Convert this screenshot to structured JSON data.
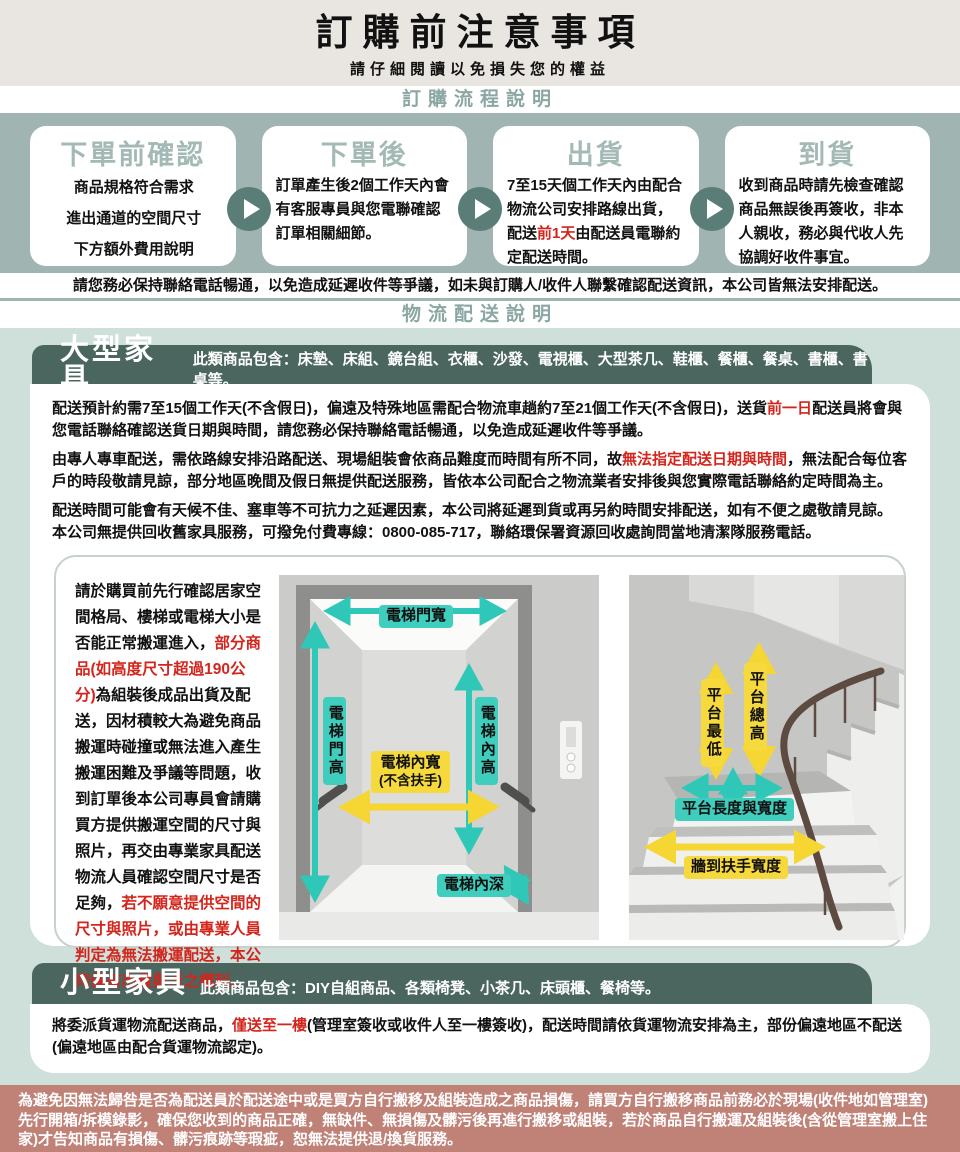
{
  "colors": {
    "band_teal": "#a0b5b1",
    "light_teal_bg": "#cfe0da",
    "dark_teal_header": "#4a665f",
    "heading_teal_text": "#8ba7a3",
    "step_title_teal": "#a3b9b5",
    "arrow_circle": "#5a7d77",
    "accent_red": "#d3251c",
    "diagram_teal": "#2fc8b8",
    "diagram_yellow": "#f5d632",
    "footer_brick": "#c08177"
  },
  "header": {
    "title": "訂購前注意事項",
    "subtitle": "請仔細閱讀以免損失您的權益"
  },
  "process": {
    "heading": "訂購流程說明",
    "steps": [
      {
        "title": "下單前確認",
        "body": [
          {
            "t": "商品規格符合需求"
          },
          {
            "br": true
          },
          {
            "t": "進出通道的空間尺寸"
          },
          {
            "br": true
          },
          {
            "t": "下方額外費用說明"
          }
        ]
      },
      {
        "title": "下單後",
        "body": [
          {
            "t": "訂單產生後2個工作天內會有客服專員與您電聯確認訂單相關細節。"
          }
        ]
      },
      {
        "title": "出貨",
        "body": [
          {
            "t": "7至15天個工作天內由配合物流公司安排路線出貨，配送"
          },
          {
            "t": "前1天",
            "red": true
          },
          {
            "t": "由配送員電聯約定配送時間。"
          }
        ]
      },
      {
        "title": "到貨",
        "body": [
          {
            "t": "收到商品時請先檢查確認商品無誤後再簽收，非本人親收，務必與代收人先協調好收件事宜。"
          }
        ]
      }
    ],
    "notice": "請您務必保持聯絡電話暢通，以免造成延遲收件等爭議，如未與訂購人/收件人聯繫確認配送資訊，本公司皆無法安排配送。"
  },
  "logistics": {
    "heading": "物流配送說明",
    "large": {
      "title": "大型家具",
      "includes": "此類商品包含：床墊、床組、鏡台組、衣櫃、沙發、電視櫃、大型茶几、鞋櫃、餐櫃、餐桌、書櫃、書桌等。",
      "p1": [
        {
          "t": "配送預計約需7至15個工作天(不含假日)，偏遠及特殊地區需配合物流車趟約7至21個工作天(不含假日)，送貨"
        },
        {
          "t": "前一日",
          "red": true
        },
        {
          "t": "配送員將會與您電話聯絡確認送貨日期與時間，請您務必保持聯絡電話暢通，以免造成延遲收件等爭議。"
        }
      ],
      "p2": [
        {
          "t": "由專人專車配送，需依路線安排沿路配送、現場組裝會依商品難度而時間有所不同，故"
        },
        {
          "t": "無法指定配送日期與時間",
          "red": true
        },
        {
          "t": "，無法配合每位客戶的時段敬請見諒，部分地區晚間及假日無提供配送服務，皆依本公司配合之物流業者安排後與您實際電話聯絡約定時間為主。"
        }
      ],
      "p3": [
        {
          "t": "配送時間可能會有天候不佳、塞車等不可抗力之延遲因素，本公司將延遲到貨或再另約時間安排配送，如有不便之處敬請見諒。"
        },
        {
          "br": true
        },
        {
          "t": "本公司無提供回收舊家具服務，可撥免付費專線：0800-085-717，聯絡環保署資源回收處詢問當地清潔隊服務電話。"
        }
      ],
      "space_note": [
        {
          "t": "請於購買前先行確認居家空間格局、樓梯或電梯大小是否能正常搬運進入，"
        },
        {
          "t": "部分商品(如高度尺寸超過190公分)",
          "red": true
        },
        {
          "t": "為組裝後成品出貨及配送，因材積較大為避免商品搬運時碰撞或無法進入產生搬運困難及爭議等問題，收到訂單後本公司專員會請購買方提供搬運空間的尺寸與照片，再交由專業家具配送物流人員確認空間尺寸是否足夠，"
        },
        {
          "t": "若不願意提供空間的尺寸與照片，或由專業人員判定為無法搬運配送，本公司保有出貨與否之權利。",
          "red": true
        }
      ],
      "elevator_labels": {
        "door_width": "電梯門寬",
        "door_height": "電梯門高",
        "inner_height": "電梯內高",
        "inner_width": "電梯內寬",
        "inner_width_note": "(不含扶手)",
        "inner_depth": "電梯內深"
      },
      "stairs_labels": {
        "platform_min": "平台最低",
        "platform_total": "平台總高",
        "platform_lw": "平台長度與寬度",
        "wall_rail": "牆到扶手寬度"
      }
    },
    "small": {
      "title": "小型家具",
      "includes": "此類商品包含：DIY自組商品、各類椅凳、小茶几、床頭櫃、餐椅等。",
      "p1": [
        {
          "t": "將委派貨運物流配送商品，"
        },
        {
          "t": "僅送至一樓",
          "red": true
        },
        {
          "t": "(管理室簽收或收件人至一樓簽收)，配送時間請依貨運物流安排為主，部份偏遠地區不配送(偏遠地區由配合貨運物流認定)。"
        }
      ]
    }
  },
  "footer": {
    "text": "為避免因無法歸咎是否為配送員於配送途中或是買方自行搬移及組裝造成之商品損傷，請買方自行搬移商品前務必於現場(收件地如管理室)先行開箱/拆模錄影，確保您收到的商品正確，無缺件、無損傷及髒污後再進行搬移或組裝，若於商品自行搬運及組裝後(含從管理室搬上住家)才告知商品有損傷、髒污痕跡等瑕疵，恕無法提供退/換貨服務。"
  }
}
